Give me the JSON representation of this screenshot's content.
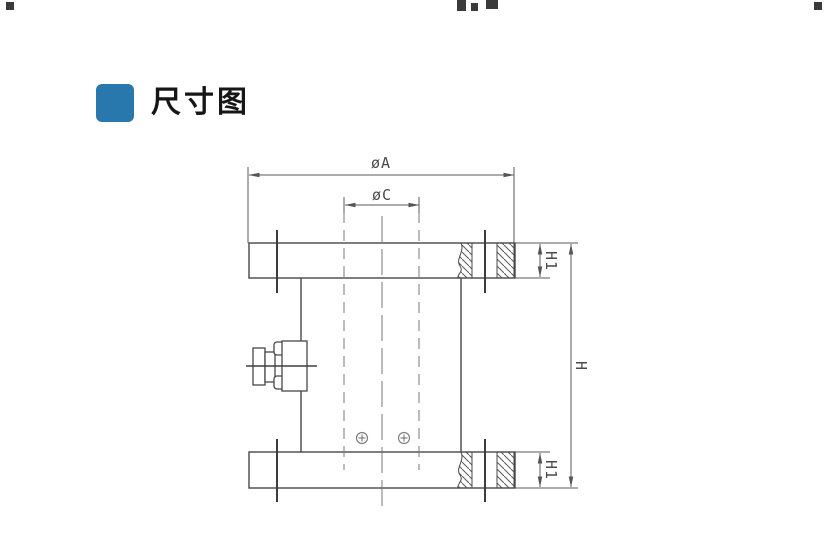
{
  "header": {
    "title": "尺寸图",
    "accent_color": "#2878ae"
  },
  "drawing": {
    "labels": {
      "dia_a": "øA",
      "dia_c": "øC",
      "h1_top": "H1",
      "h1_bottom": "H1",
      "h_total": "H"
    },
    "line_color": "#474747",
    "dim_color": "#5a5a5a"
  }
}
